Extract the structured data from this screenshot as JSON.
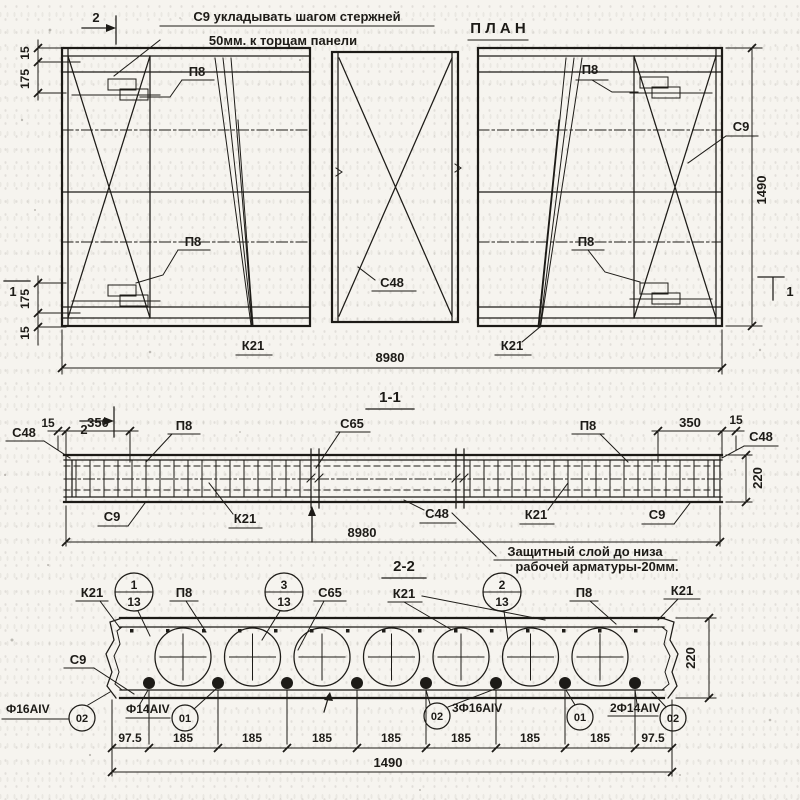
{
  "plan": {
    "note_line1": "С9 укладывать шагом стержней",
    "note_line2": "50мм. к торцам панели",
    "title": "П Л А Н",
    "label_p8": "П8",
    "label_c48": "С48",
    "label_c9": "С9",
    "label_k21": "К21",
    "dim_15": "15",
    "dim_175": "175",
    "dim_1490": "1490",
    "dim_8980": "8980",
    "marker_1": "1",
    "marker_2": "2"
  },
  "section1": {
    "title": "1-1",
    "label_c48": "С48",
    "label_c65": "С65",
    "label_c9": "С9",
    "label_p8": "П8",
    "label_k21": "К21",
    "dim_15": "15",
    "dim_350": "350",
    "dim_220": "220",
    "dim_8980": "8980"
  },
  "section2": {
    "title": "2-2",
    "note_line1": "Защитный слой до низа",
    "note_line2": "рабочей арматуры-20мм.",
    "label_k21": "К21",
    "label_p8": "П8",
    "label_c65": "С65",
    "label_c9": "С9",
    "pos_ball_1_num": "1",
    "pos_ball_1_qty": "13",
    "pos_ball_2_num": "2",
    "pos_ball_2_qty": "13",
    "pos_ball_3_num": "3",
    "pos_ball_3_qty": "13",
    "rebar_f16": "Ф16АIV",
    "rebar_f14": "Ф14АIV",
    "rebar_3f16": "3Ф16АIV",
    "rebar_2f14": "2Ф14АIV",
    "pos_01": "01",
    "pos_02": "02",
    "dim_97_5": "97.5",
    "dim_185": "185",
    "dim_1490": "1490",
    "dim_220": "220"
  },
  "colors": {
    "ink": "#1d1b17",
    "paper": "#f6f4ef"
  }
}
